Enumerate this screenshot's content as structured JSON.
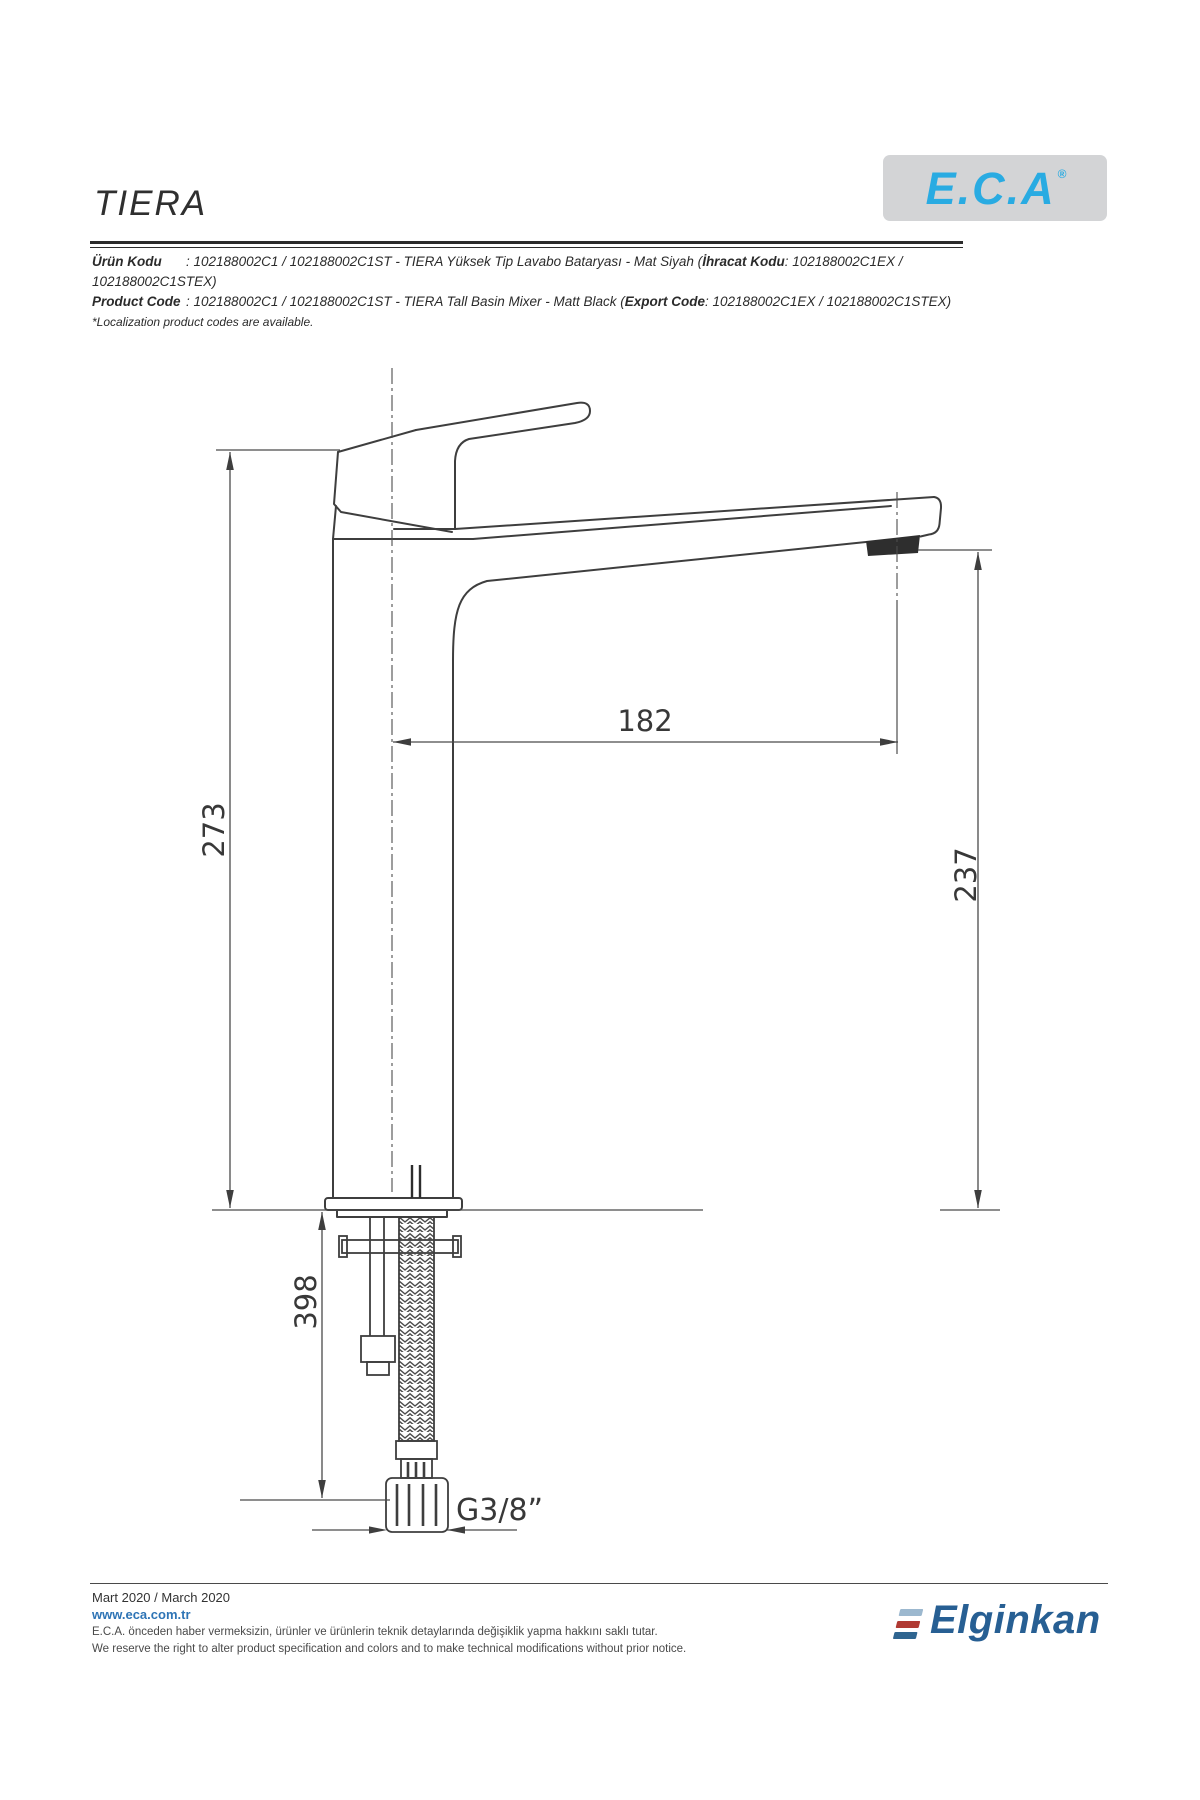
{
  "header": {
    "title": "TIERA",
    "brand_logo": "E.C.A",
    "brand_reg": "®"
  },
  "product_info": {
    "line1": {
      "label": "Ürün Kodu",
      "colon": ": ",
      "text_a": "102188002C1 / 102188002C1ST - TIERA Yüksek Tip Lavabo Bataryası - Mat Siyah (",
      "bold_b": "İhracat Kodu",
      "text_c": ": 102188002C1EX / 102188002C1STEX)"
    },
    "line2": {
      "label": "Product Code",
      "colon": ": ",
      "text_a": "102188002C1 / 102188002C1ST - TIERA Tall Basin Mixer - Matt Black (",
      "bold_b": "Export Code",
      "text_c": ": 102188002C1EX / 102188002C1STEX)"
    },
    "note": "*Localization product codes are available."
  },
  "drawing": {
    "dimensions": {
      "total_height": "273",
      "spout_reach": "182",
      "spout_height": "237",
      "under_deck": "398",
      "connection": "G3/8”"
    }
  },
  "footer": {
    "date": "Mart 2020 / March 2020",
    "website": "www.eca.com.tr",
    "note_tr": "E.C.A. önceden haber vermeksizin, ürünler ve ürünlerin teknik detaylarında değişiklik yapma hakkını saklı tutar.",
    "note_en": "We reserve the right to alter product specification and colors and to make technical modifications without prior notice.",
    "company_logo": "Elginkan"
  },
  "colors": {
    "brand_blue": "#29abe2",
    "elginkan_blue": "#275f93",
    "logo_red": "#b03a33",
    "logo_lightblue": "#9cb8cf",
    "line": "#3e3e3e"
  }
}
